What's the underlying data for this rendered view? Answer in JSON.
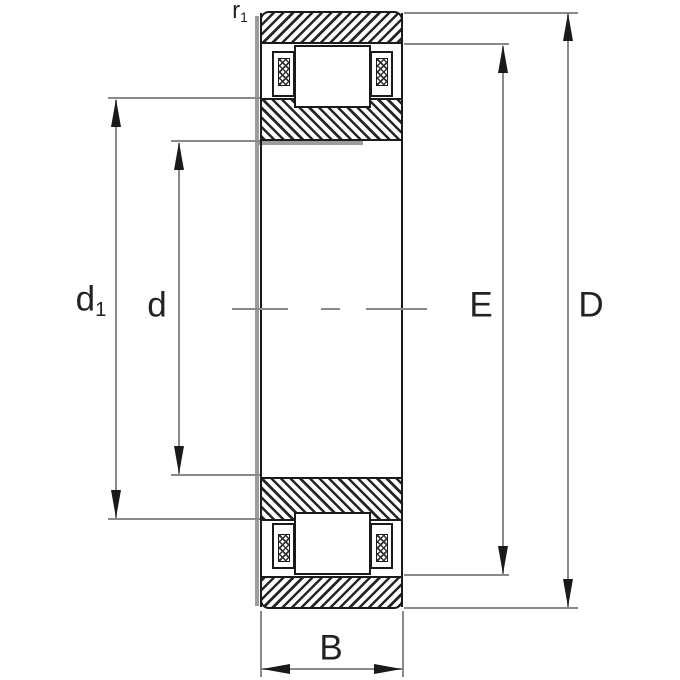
{
  "drawing": {
    "type": "bearing-cross-section-drawing",
    "dimension_labels": {
      "r1": {
        "main": "r",
        "sub": "1"
      },
      "d1": {
        "main": "d",
        "sub": "1"
      },
      "d": {
        "main": "d",
        "sub": ""
      },
      "E": {
        "main": "E",
        "sub": ""
      },
      "D": {
        "main": "D",
        "sub": ""
      },
      "B": {
        "main": "B",
        "sub": ""
      }
    }
  },
  "colors": {
    "line": "#1a1a1a",
    "dim": "#8a8a8a",
    "shadow": "#9c9c9c",
    "label": "#222222",
    "background": "#ffffff"
  }
}
